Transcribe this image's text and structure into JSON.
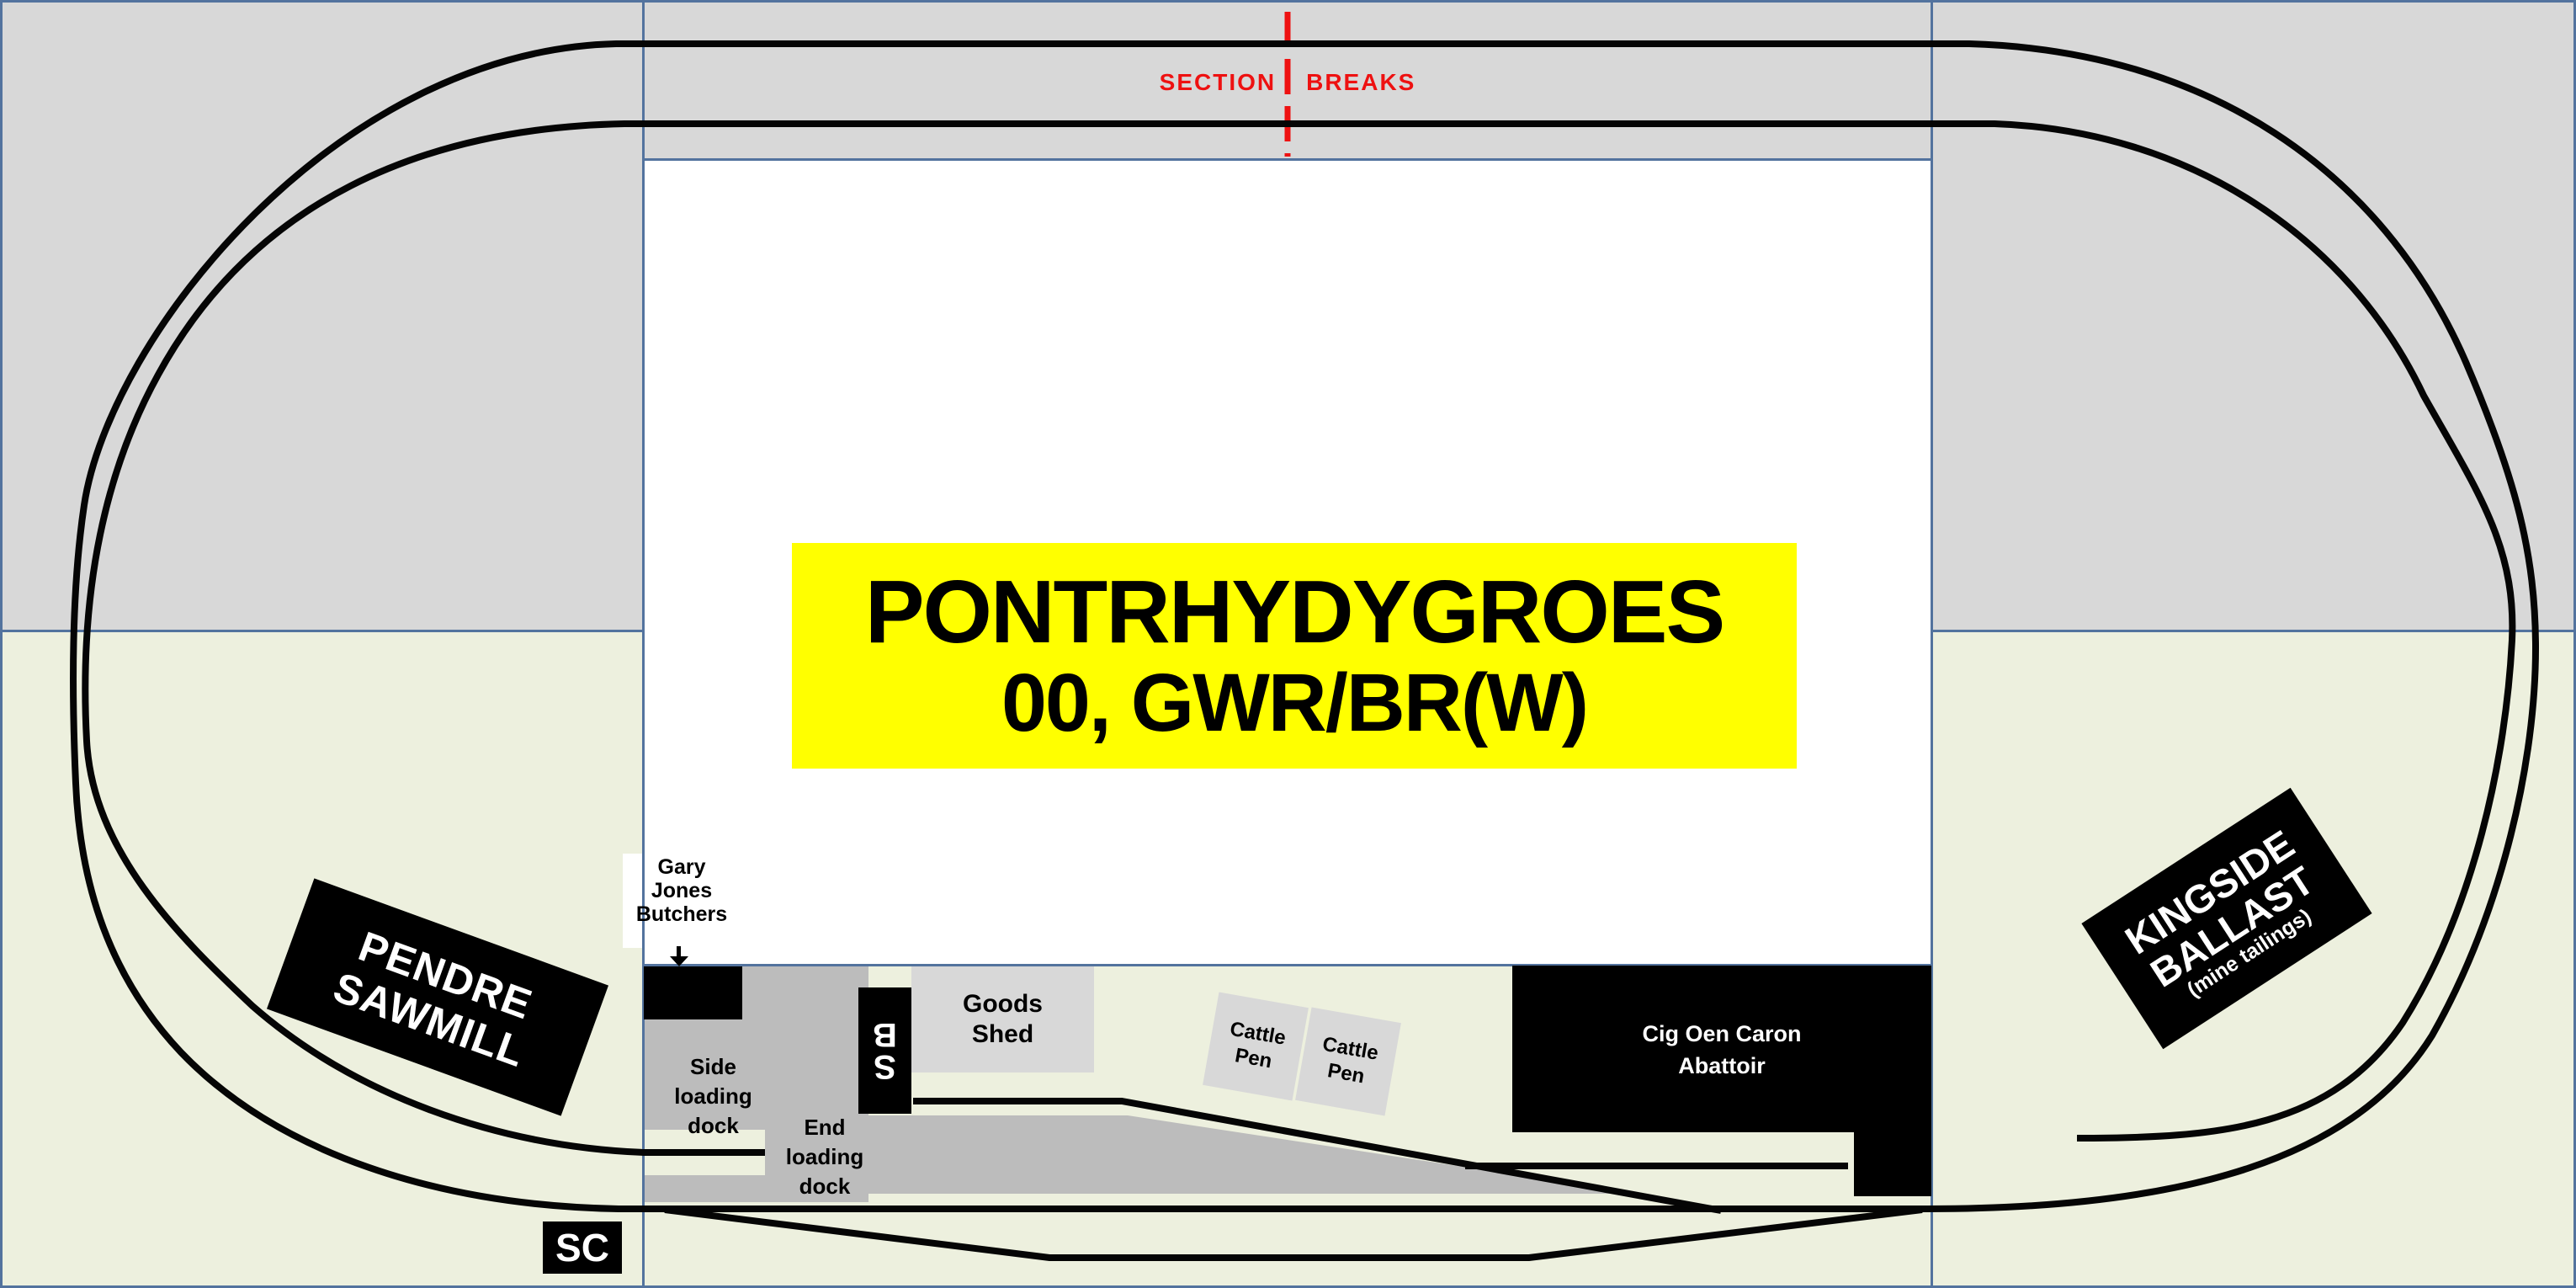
{
  "colors": {
    "grey": "#d8d8d8",
    "green": "#edf0de",
    "platform": "#bcbcbc",
    "blue": "#53739e",
    "red": "#ee1111",
    "yellow": "#ffff00",
    "track": "#050505"
  },
  "section_breaks": {
    "word1": "SECTION",
    "word2": "BREAKS"
  },
  "title": {
    "line1": "PONTRHYDYGROES",
    "line2": "00, GWR/BR(W)"
  },
  "sawmill": {
    "line1": "PENDRE",
    "line2": "SAWMILL"
  },
  "butchers": {
    "line1": "Gary",
    "line2": "Jones",
    "line3": "Butchers"
  },
  "side_dock": {
    "line1": "Side",
    "line2": "loading",
    "line3": "dock"
  },
  "end_dock": {
    "line1": "End",
    "line2": "loading",
    "line3": "dock"
  },
  "signal_box": {
    "letters": [
      "S",
      "B"
    ]
  },
  "section_change": {
    "label": "SC"
  },
  "goods_shed": {
    "line1": "Goods",
    "line2": "Shed"
  },
  "cattle_pen_1": {
    "line1": "Cattle",
    "line2": "Pen"
  },
  "cattle_pen_2": {
    "line1": "Cattle",
    "line2": "Pen"
  },
  "abattoir": {
    "line1": "Cig Oen Caron",
    "line2": "Abattoir"
  },
  "kingside": {
    "line1": "KINGSIDE",
    "line2": "BALLAST",
    "line3": "(mine tailings)"
  }
}
